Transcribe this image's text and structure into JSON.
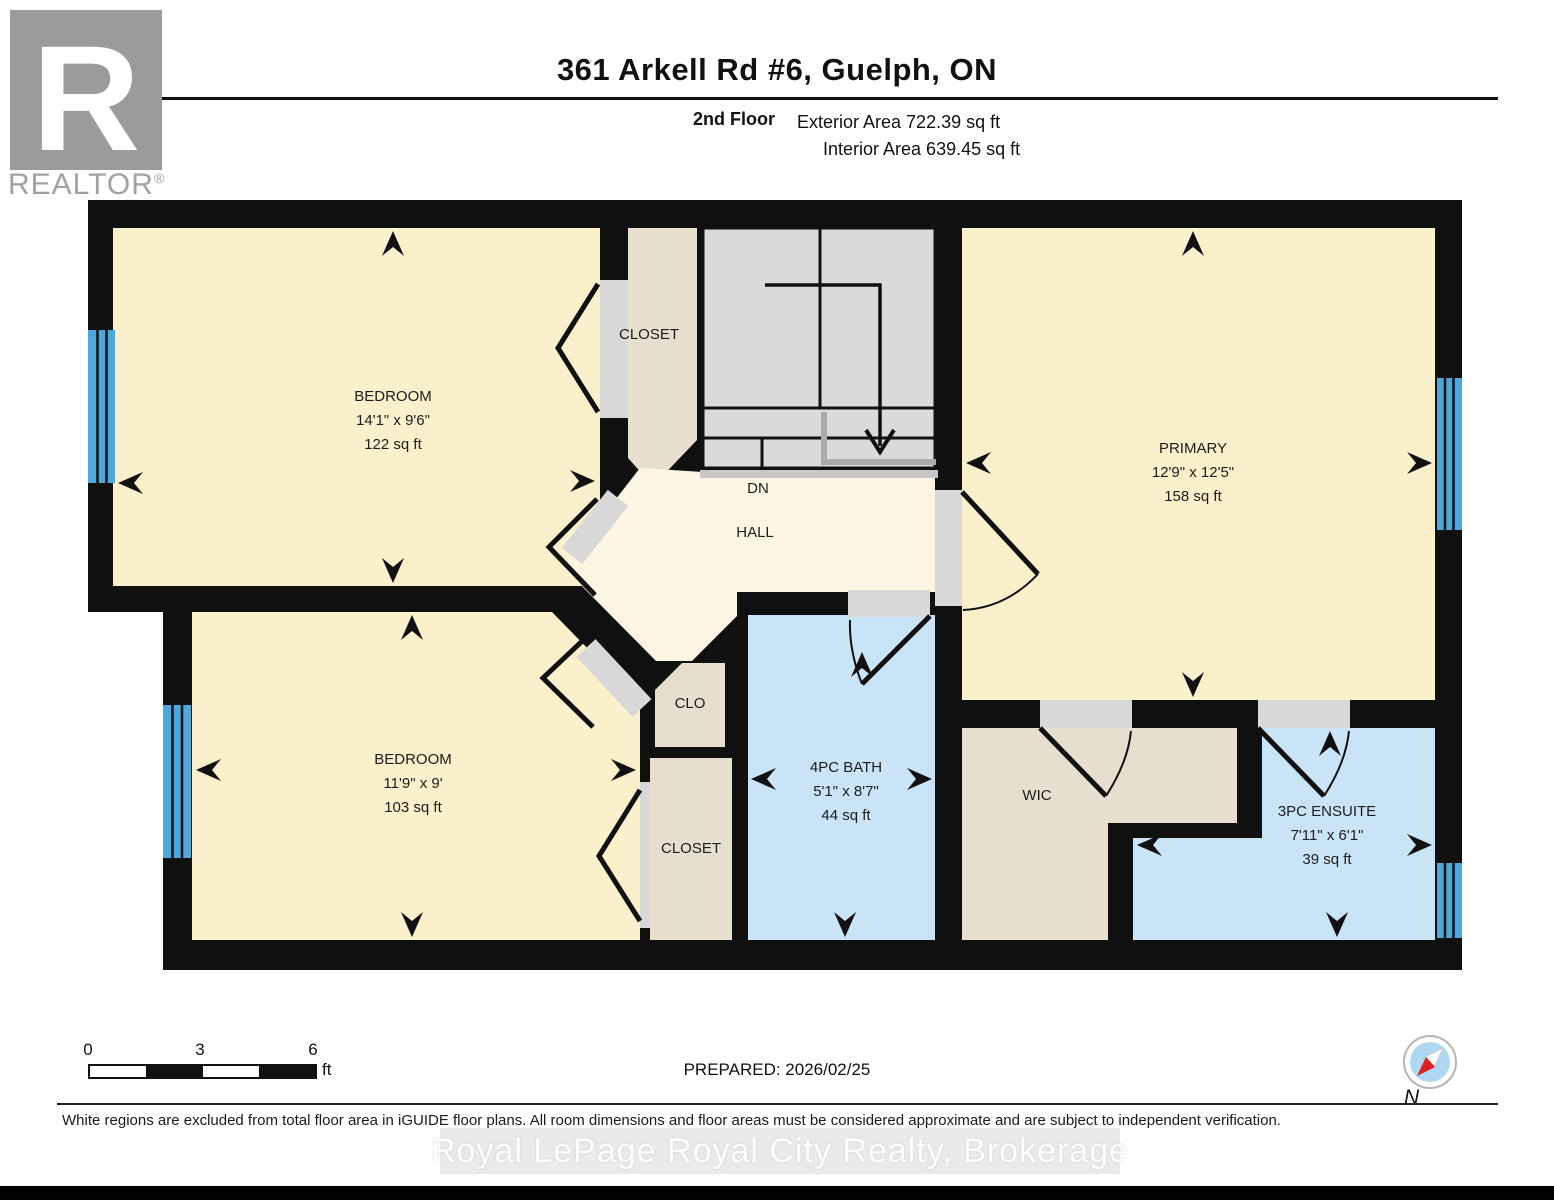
{
  "header": {
    "title": "361 Arkell Rd #6, Guelph, ON",
    "floor_label": "2nd Floor",
    "exterior_area": "Exterior Area 722.39 sq ft",
    "interior_area": "Interior Area 639.45 sq ft"
  },
  "branding": {
    "logo_letter": "R",
    "wordmark": "REALTOR",
    "registered": "®"
  },
  "rooms": {
    "bedroom1": {
      "name": "BEDROOM",
      "dims": "14'1\" x 9'6\"",
      "area": "122 sq ft"
    },
    "closet_top": {
      "name": "CLOSET"
    },
    "stairs": {
      "direction_label": "DN"
    },
    "hall": {
      "name": "HALL"
    },
    "primary": {
      "name": "PRIMARY",
      "dims": "12'9\" x 12'5\"",
      "area": "158 sq ft"
    },
    "bedroom2": {
      "name": "BEDROOM",
      "dims": "11'9\" x 9'",
      "area": "103 sq ft"
    },
    "clo": {
      "name": "CLO"
    },
    "closet_bottom": {
      "name": "CLOSET"
    },
    "bath": {
      "name": "4PC BATH",
      "dims": "5'1\" x 8'7\"",
      "area": "44 sq ft"
    },
    "wic": {
      "name": "WIC"
    },
    "ensuite": {
      "name": "3PC ENSUITE",
      "dims": "7'11\" x 6'1\"",
      "area": "39 sq ft"
    }
  },
  "footer": {
    "scale_bar": {
      "tick_labels": [
        "0",
        "3",
        "6"
      ],
      "unit": "ft"
    },
    "prepared": "PREPARED: 2026/02/25",
    "compass_label": "N",
    "disclaimer": "White regions are excluded from total floor area in iGUIDE floor plans. All room dimensions and floor areas must be considered approximate and are subject to independent verification.",
    "watermark": "Royal LePage Royal City Realty, Brokerage"
  },
  "colors": {
    "wall": "#101010",
    "room_cream": "#FAF0CB",
    "hall_cream": "#FBF5E1",
    "closet_beige": "#E6DFCE",
    "bath_blue": "#C9E4F6",
    "stairs_gray": "#DADADA",
    "window_blue": "#4FA8DC",
    "door_sill_gray": "#D8D8D8"
  }
}
